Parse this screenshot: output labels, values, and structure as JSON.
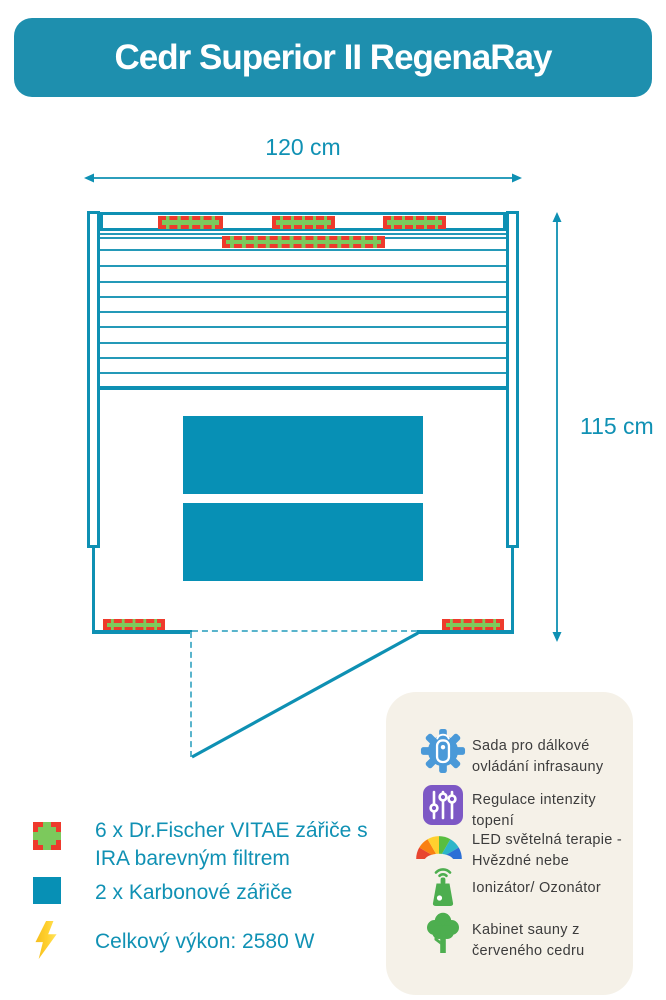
{
  "title": "Cedr Superior II RegenaRay",
  "dimensions": {
    "width": "120 cm",
    "height": "115 cm"
  },
  "legend": {
    "items": [
      {
        "icon": "vitae-heater-swatch",
        "label": "6 x Dr.Fischer VITAE zářiče s IRA barevným filtrem"
      },
      {
        "icon": "carbon-heater-swatch",
        "label": "2 x Karbonové zářiče"
      },
      {
        "icon": "lightning-bolt-icon",
        "label": "Celkový výkon: 2580 W"
      }
    ]
  },
  "features": {
    "items": [
      {
        "icon": "remote-control-gear-icon",
        "label": "Sada pro dálkové ovládání infrasauny"
      },
      {
        "icon": "intensity-sliders-icon",
        "label": "Regulace intenzity topení"
      },
      {
        "icon": "led-rainbow-icon",
        "label": "LED světelná terapie - Hvězdné nebe"
      },
      {
        "icon": "ionizer-icon",
        "label": "Ionizátor/ Ozonátor"
      },
      {
        "icon": "cedar-tree-icon",
        "label": "Kabinet sauny z červeného cedru"
      }
    ]
  },
  "floorplan": {
    "heaters_vitae_count": 6,
    "heaters_carbon_count": 2
  },
  "colors": {
    "teal": "#0E90B3",
    "banner_teal": "#1E8FAE",
    "heater_red": "#EE3A2C",
    "heater_green": "#7CC95C",
    "bolt_yellow": "#FFD02E",
    "panel_bg": "#F5F1E8",
    "icon_blue": "#4A99D8",
    "icon_purple": "#7D58C5",
    "icon_green": "#4DAE4F",
    "feature_text": "#3C3C3C"
  }
}
